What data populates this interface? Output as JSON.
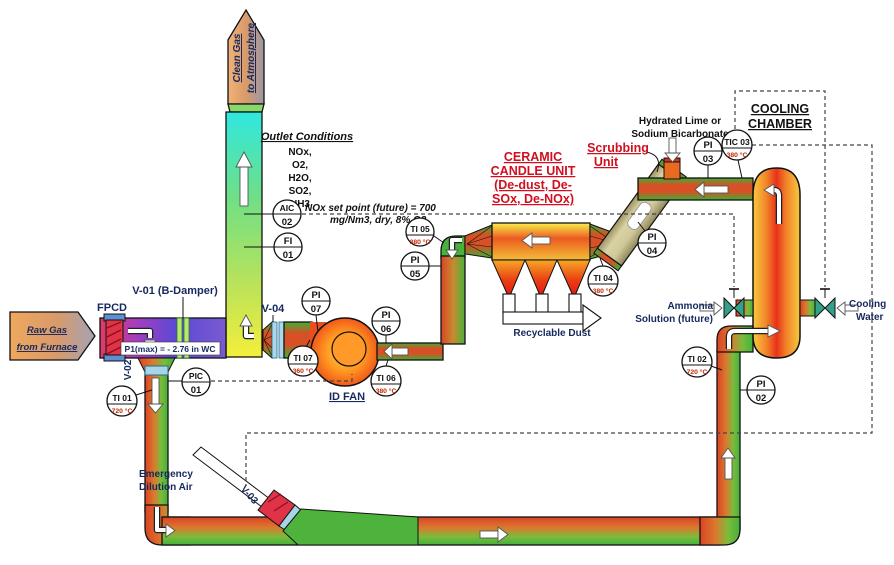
{
  "colors": {
    "label_navy": "#16295e",
    "label_black": "#111111",
    "label_red": "#cf1020",
    "temp_red": "#c32700",
    "pipe_red": "#dd4326",
    "pipe_green": "#43b23a",
    "stack_cyan": "#2fe8e0",
    "inlet_duct_purple": "#7a3fd0",
    "vessel_red": "#e9321b",
    "scrubber_tan": "#d9d2a4",
    "fan_orange": "#ff9c22"
  },
  "labels": {
    "clean_gas_line1": "Clean Gas",
    "clean_gas_line2": "to Atmosphere",
    "outlet_title": "Outlet  Conditions",
    "outlet_items": [
      "NOx,",
      "O2,",
      "H2O,",
      "SO2,",
      "NH3"
    ],
    "nox_sp1": "NOx set point (future) = 700",
    "nox_sp2": "mg/Nm3, dry, 8% O2",
    "v01": "V-01 (B-Damper)",
    "fpcd": "FPCD",
    "raw_gas1": "Raw Gas",
    "raw_gas2": "from Furnace",
    "p1max": "P1(max) = - 2.76 in WC",
    "v02": "V-02",
    "v03": "V-03",
    "v04": "V-04",
    "id_fan": "ID FAN",
    "ceramic1": "CERAMIC",
    "ceramic2": "CANDLE UNIT",
    "ceramic3": "(De-dust, De-",
    "ceramic4": "SOx, De-NOx)",
    "scrubbing1": "Scrubbing",
    "scrubbing2": "Unit",
    "recyclable_dust": "Recyclable Dust",
    "hydrated1": "Hydrated Lime or",
    "hydrated2": "Sodium Bicarbonate",
    "cooling_chamber1": "COOLING",
    "cooling_chamber2": "CHAMBER",
    "ammonia1": "Ammonia",
    "ammonia2": "Solution (future)",
    "cooling_water1": "Cooling",
    "cooling_water2": "Water",
    "emergency1": "Emergency",
    "emergency2": "Dilution Air"
  },
  "instruments": {
    "aic02": {
      "line1": "AIC",
      "line2": "02"
    },
    "fi01": {
      "line1": "FI",
      "line2": "01"
    },
    "pic01": {
      "line1": "PIC",
      "line2": "01"
    },
    "pi02": {
      "line1": "PI",
      "line2": "02"
    },
    "pi03": {
      "line1": "PI",
      "line2": "03"
    },
    "pi04": {
      "line1": "PI",
      "line2": "04"
    },
    "pi05": {
      "line1": "PI",
      "line2": "05"
    },
    "pi06": {
      "line1": "PI",
      "line2": "06"
    },
    "pi07": {
      "line1": "PI",
      "line2": "07"
    },
    "ti01": {
      "tag": "TI 01",
      "temp": "720 °C"
    },
    "ti02": {
      "tag": "TI 02",
      "temp": "720 °C"
    },
    "tic03": {
      "tag": "TIC 03",
      "temp": "380 °C"
    },
    "ti04": {
      "tag": "TI 04",
      "temp": "380 °C"
    },
    "ti05": {
      "tag": "TI 05",
      "temp": "380 °C"
    },
    "ti06": {
      "tag": "TI 06",
      "temp": "380 °C"
    },
    "ti07": {
      "tag": "TI 07",
      "temp": "360 °C"
    }
  }
}
